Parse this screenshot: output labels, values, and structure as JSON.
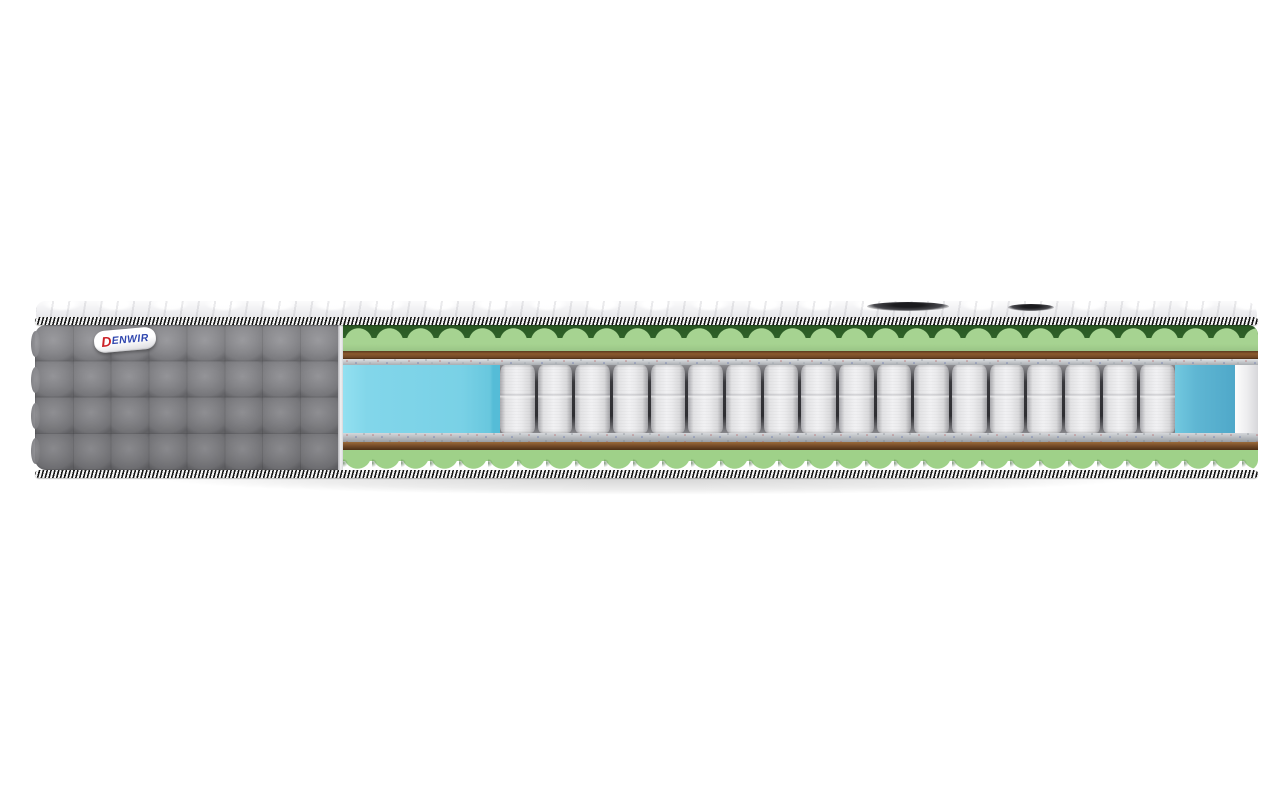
{
  "scene": {
    "kind": "product-photo",
    "subject": "Cutaway render of a pocket-spring mattress",
    "background_color": "#ffffff"
  },
  "brand": {
    "name": "DENWIR",
    "initial": "D",
    "rest": "ENWIR"
  },
  "mattress": {
    "cover": {
      "style": "quilted-squares",
      "quilt_columns": 8,
      "quilt_rows": 4,
      "color": "#87878b"
    },
    "piping_stripe_colors": [
      "#161616",
      "#f4f4f4"
    ],
    "layers": [
      {
        "name": "quilted-top-cover",
        "color": "#f1f1f3"
      },
      {
        "name": "wave-foam-top",
        "color": "#a6d391"
      },
      {
        "name": "coir-sheet-top",
        "color": "#744b27"
      },
      {
        "name": "felt-pad-top",
        "color": "#c6cacf"
      },
      {
        "name": "pocket-spring-block",
        "color": "#eeeef0"
      },
      {
        "name": "felt-pad-bottom",
        "color": "#b2b7bd"
      },
      {
        "name": "coir-sheet-bottom",
        "color": "#744b27"
      },
      {
        "name": "wave-foam-bottom",
        "color": "#9fd189"
      }
    ],
    "core": {
      "spring_count": 18,
      "spring_color": "#eeeef0",
      "spring_gap_color": "#2e2e32",
      "side_support_color": "#82d6ea",
      "side_support_right_color": "#5fb6d3"
    }
  },
  "colors": {
    "bg": "#ffffff",
    "fabric": "#87878b",
    "fabric_dark": "#68686c",
    "fabric_light": "#96969a",
    "piping_dark": "#161616",
    "piping_light": "#f4f4f4",
    "foam_green": "#a6d391",
    "foam_green2": "#9fd189",
    "foam_green_deep": "#2e6128",
    "coir_brown": "#744b27",
    "felt_gray": "#c6cacf",
    "felt_gray2": "#b2b7bd",
    "spring_light": "#f1f1f3",
    "spring_dark": "#a9a9ad",
    "spring_gap": "#2e2e32",
    "blue_foam": "#82d6ea",
    "blue_foam_side": "#55bcd7",
    "blue_foam_right": "#5fb6d3",
    "logo_red": "#cc2127",
    "logo_blue": "#2f46ae",
    "label_bg": "#ffffff"
  }
}
